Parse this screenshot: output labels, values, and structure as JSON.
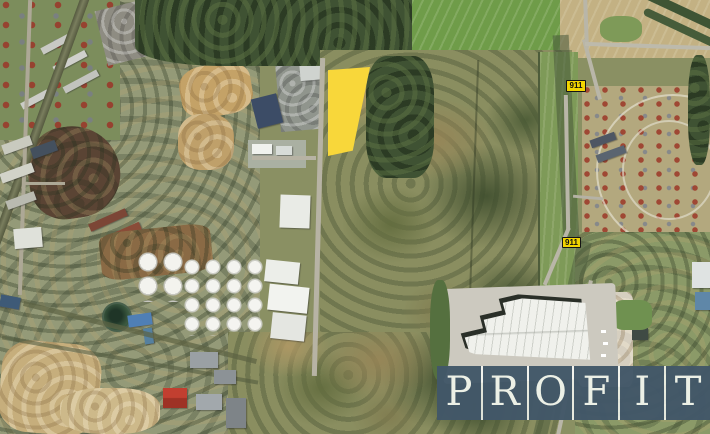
{
  "map": {
    "type": "aerial-satellite-photo",
    "route_badges": [
      {
        "label": "911",
        "position": "north"
      },
      {
        "label": "911",
        "position": "south"
      }
    ],
    "parcel_highlight": {
      "color": "#F8D73A"
    },
    "badge_style": {
      "background": "#F2D500",
      "border": "#141414",
      "text_color": "#101010"
    }
  },
  "watermark": {
    "brand": "PROFIT",
    "letters": [
      "P",
      "R",
      "O",
      "F",
      "I",
      "T"
    ],
    "tile_color": "rgba(22,48,70,0.78)",
    "letter_color": "#ecf0e6",
    "separator_color": "rgba(248,250,245,0.85)"
  }
}
